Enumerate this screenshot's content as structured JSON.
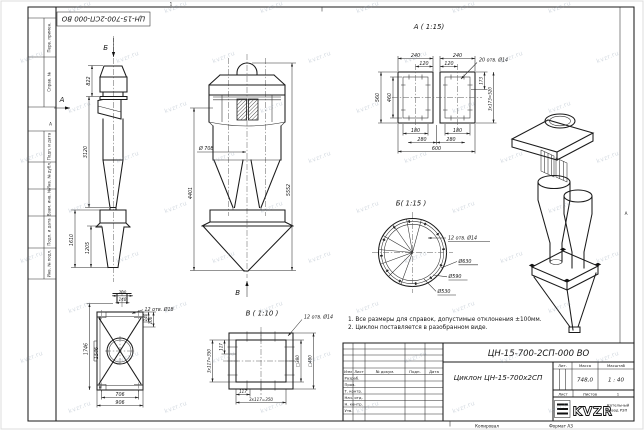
{
  "colors": {
    "line": "#1b1b1b",
    "paper": "#ffffff",
    "watermark": "rgba(128,148,168,0.34)"
  },
  "watermark": {
    "text": "kvzr.ru"
  },
  "frame": {
    "stamp_top_left": "ЦН-15-700-2СП-000 ВО",
    "zone_top": "1",
    "zone_left": "А",
    "zone_right": "А",
    "margin_fields": {
      "perv": "Перв. примен.",
      "sprav": "Справ. №",
      "podp1": "Подп. и дата",
      "inv_dubl": "Инв. № дубл.",
      "vzam": "Взам. инв. №",
      "podp2": "Подп. и дата",
      "inv_podl": "Инв. № подл."
    },
    "footer_copy": "Копировал",
    "footer_format": "Формат А3"
  },
  "views": {
    "side": {
      "arrow_a": "А",
      "arrow_b": "Б",
      "dim_822": "822",
      "dim_3120": "3120",
      "dim_1610": "1610",
      "dim_1205": "1205"
    },
    "front": {
      "arrow_v": "В",
      "dim_d708": "Ø 708",
      "dim_4401": "4401",
      "dim_5552": "5552"
    },
    "section_a": {
      "title": "А ( 1:15)",
      "dim_240_l": "240",
      "dim_240_r": "240",
      "dim_120_l": "120",
      "dim_120_r": "120",
      "holes": "20 отв. Ø14",
      "dim_560": "560",
      "dim_460": "460",
      "dim_173": "173",
      "dim_pitch": "3х173=520",
      "dim_180_l": "180",
      "dim_180_r": "180",
      "dim_280_l": "280",
      "dim_280_r": "280",
      "dim_600": "600"
    },
    "section_b": {
      "title": "Б( 1:15 )",
      "holes": "12 отв. Ø14",
      "dim_630": "Ø630",
      "dim_590": "Ø590",
      "dim_530": "Ø530"
    },
    "support": {
      "dim_200": "200",
      "dim_140_top": "140",
      "holes": "12 отв. Ø18",
      "dim_140_r": "140",
      "dim_100": "100",
      "dim_1746": "1746",
      "dim_1546": "1546",
      "dim_706": "706",
      "dim_906": "906"
    },
    "section_v": {
      "title": "В ( 1:10 )",
      "holes": "12 отв. Ø14",
      "dim_117_l": "117",
      "dim_pitch_l": "3х117=350",
      "dim_380": "□380",
      "dim_480": "□480",
      "dim_117_b": "117",
      "dim_pitch_b": "3х117=350"
    }
  },
  "notes": [
    "1. Все размеры для справок, допустимые отклонения ±100мм.",
    "2. Циклон поставляется в разобранном виде."
  ],
  "title_block": {
    "doc_number": "ЦН-15-700-2СП-000 ВО",
    "doc_name": "Циклон ЦН-15-700х2СП",
    "col_izm": "Изм",
    "col_list": "Лист",
    "col_doc": "№ докум.",
    "col_podp": "Подп.",
    "col_data": "Дата",
    "rows": [
      "Разраб.",
      "Пров.",
      "Т. контр.",
      "Нач. отд.",
      "Н. контр.",
      "Утв."
    ],
    "lit_label": "Лит.",
    "mass_label": "Масса",
    "scale_label": "Масштаб",
    "mass_value": "748,0",
    "scale_value": "1 : 40",
    "sheet_label": "Лист",
    "sheets_label": "Листов",
    "sheets_value": "1",
    "logo_text": "KVZR",
    "company_line1": "Котельный",
    "company_line2": "завод РЗП"
  }
}
